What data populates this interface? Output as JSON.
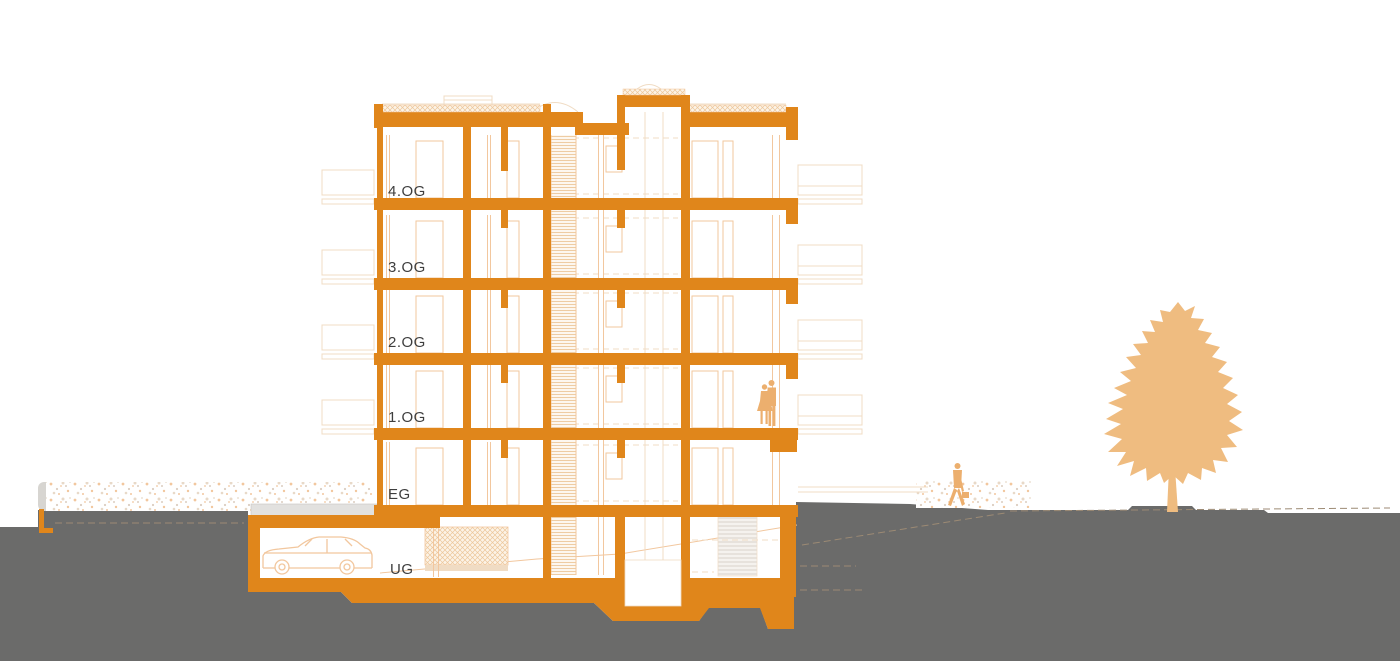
{
  "title": "Building cross-section drawing",
  "floors": [
    {
      "id": "4og",
      "label": "4.OG"
    },
    {
      "id": "3og",
      "label": "3.OG"
    },
    {
      "id": "2og",
      "label": "2.OG"
    },
    {
      "id": "1og",
      "label": "1.OG"
    },
    {
      "id": "eg",
      "label": "EG"
    },
    {
      "id": "ug",
      "label": "UG"
    }
  ],
  "scene": {
    "figures": [
      "couple-on-balcony",
      "walking-person-with-briefcase",
      "tree",
      "car-in-garage"
    ]
  },
  "colors": {
    "orange": "#E0861B",
    "light": "#F2C79E",
    "faint": "#F0DCC4",
    "hatch": "#EDC79B",
    "figure": "#ECAF6E",
    "tree": "#EFBC80",
    "ground": "#6B6B6A",
    "driveway": "#E2E1DF",
    "dash_tan": "#9C8A74",
    "label": "#3E3E3E"
  }
}
